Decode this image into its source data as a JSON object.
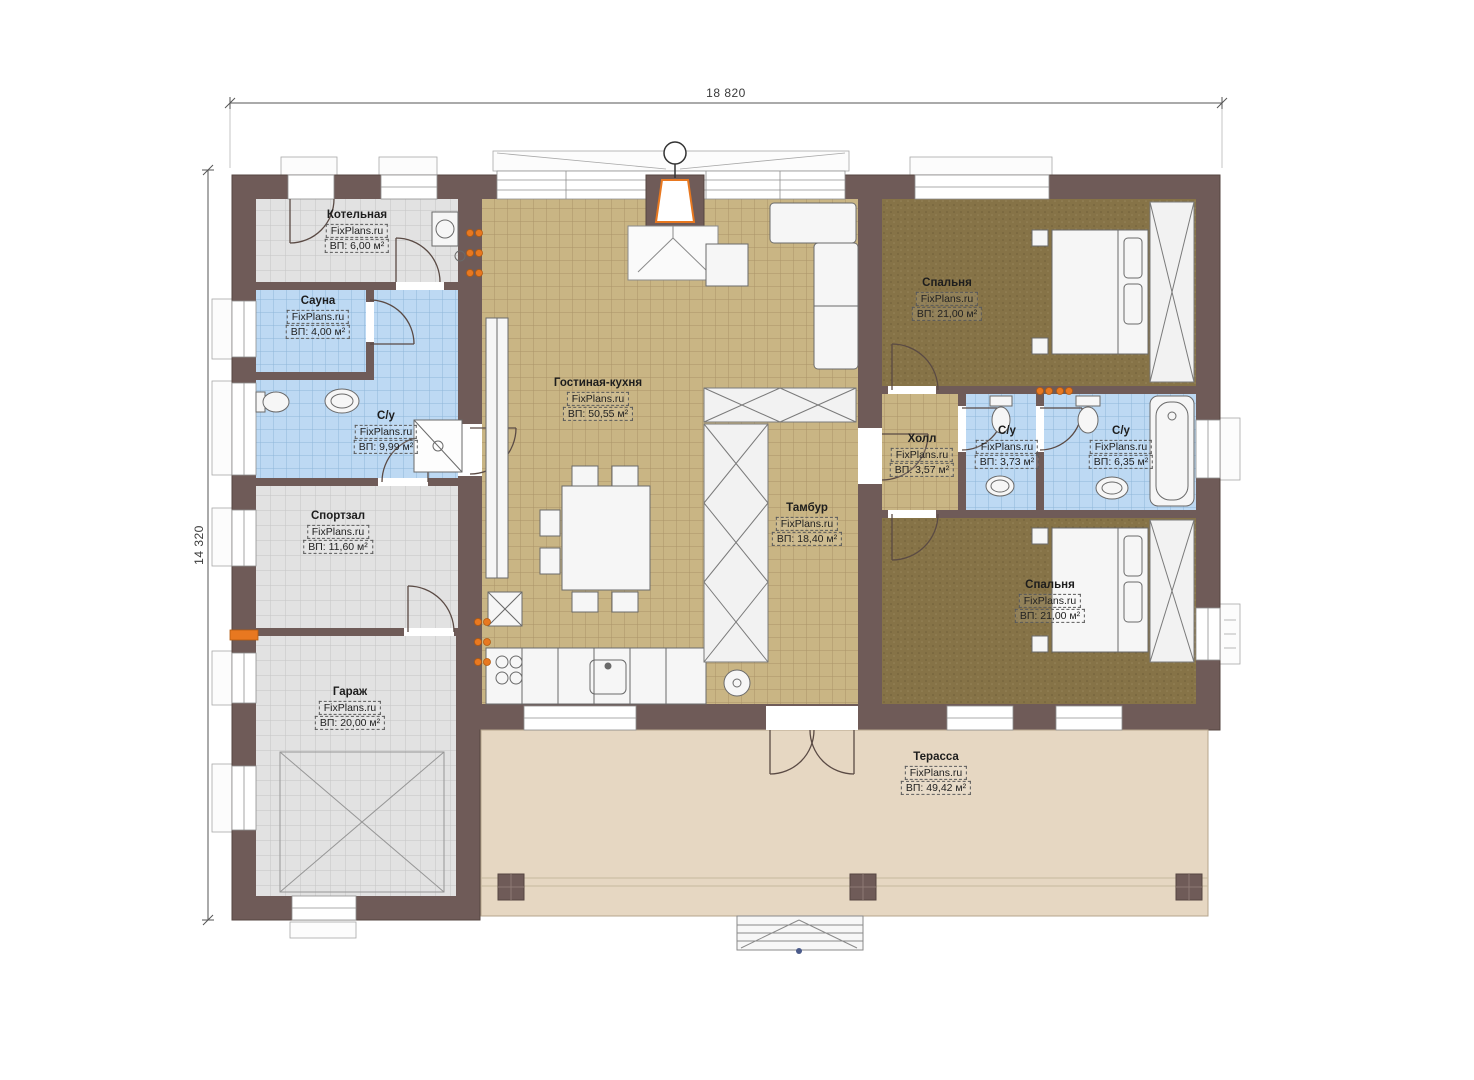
{
  "dimensions": {
    "width_label": "18 820",
    "height_label": "14 320"
  },
  "watermark": "FixPlans.ru",
  "rooms": {
    "boiler": {
      "name": "Котельная",
      "brand": "FixPlans.ru",
      "area": "ВП: 6,00 м²"
    },
    "sauna": {
      "name": "Сауна",
      "brand": "FixPlans.ru",
      "area": "ВП: 4,00 м²"
    },
    "bath_left": {
      "name": "С/у",
      "brand": "FixPlans.ru",
      "area": "ВП: 9,99 м²"
    },
    "gym": {
      "name": "Спортзал",
      "brand": "FixPlans.ru",
      "area": "ВП: 11,60 м²"
    },
    "garage": {
      "name": "Гараж",
      "brand": "FixPlans.ru",
      "area": "ВП: 20,00 м²"
    },
    "living_kitchen": {
      "name": "Гостиная-кухня",
      "brand": "FixPlans.ru",
      "area": "ВП: 50,55 м²"
    },
    "tambour": {
      "name": "Тамбур",
      "brand": "FixPlans.ru",
      "area": "ВП: 18,40 м²"
    },
    "hall": {
      "name": "Холл",
      "brand": "FixPlans.ru",
      "area": "ВП: 3,57 м²"
    },
    "bath_small": {
      "name": "С/у",
      "brand": "FixPlans.ru",
      "area": "ВП: 3,73 м²"
    },
    "bath_big": {
      "name": "С/у",
      "brand": "FixPlans.ru",
      "area": "ВП: 6,35 м²"
    },
    "bedroom_top": {
      "name": "Спальня",
      "brand": "FixPlans.ru",
      "area": "ВП: 21,00 м²"
    },
    "bedroom_bottom": {
      "name": "Спальня",
      "brand": "FixPlans.ru",
      "area": "ВП: 21,00 м²"
    },
    "terrace": {
      "name": "Терасса",
      "brand": "FixPlans.ru",
      "area": "ВП: 49,42 м²"
    }
  },
  "colors": {
    "wall": "#6F5B58",
    "tile_gray": "#E2E2E2",
    "tile_blue": "#BDD9F3",
    "tile_tan": "#C9B584",
    "carpet_brown": "#867347",
    "terrace_wood": "#E6D7C2",
    "heater_orange": "#E87820"
  }
}
